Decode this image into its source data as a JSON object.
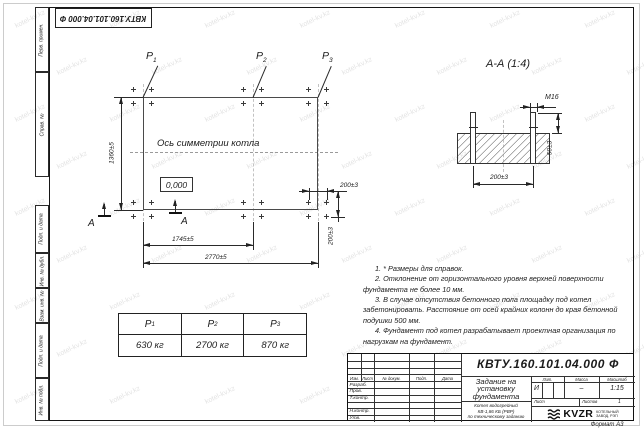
{
  "doc": {
    "number": "КВТУ.160.101.04.000 Ф",
    "format": "Формат А3",
    "watermark": "kotel-kv.kz"
  },
  "margin_fields": [
    "Перв. примен.",
    "Справ. №",
    "Подп. и дата",
    "Инв. № дубл.",
    "Взам. инв. №",
    "Подп. и дата",
    "Инв. № подл."
  ],
  "plan": {
    "axis_label": "Ось симметрии котла",
    "elevation": "0,000",
    "dims": {
      "height": "1360±5",
      "width_inner": "1745±5",
      "width_total": "2770±5",
      "cluster_h": "200±3",
      "cluster_v": "200±3"
    },
    "section_letter": "А",
    "load_points": [
      {
        "base": "P",
        "sub": "1"
      },
      {
        "base": "P",
        "sub": "2"
      },
      {
        "base": "P",
        "sub": "3"
      }
    ]
  },
  "section": {
    "title": "А-А (1:4)",
    "thread": "М16",
    "dims": {
      "spacing": "200±3",
      "protrusion": "50±3"
    }
  },
  "load_table": {
    "headers": [
      {
        "base": "P",
        "sub": "1"
      },
      {
        "base": "P",
        "sub": "2"
      },
      {
        "base": "P",
        "sub": "3"
      }
    ],
    "values": [
      "630 кг",
      "2700 кг",
      "870 кг"
    ]
  },
  "notes": [
    "1. * Размеры для справок.",
    "2. Отклонение от горизонтального уровня верхней поверхности фундамента не более 10 мм.",
    "3. В случае отсутствия бетонного пола площадку под котел забетонировать. Расстояние от осей крайних колонн до края бетонной подушки 500 мм.",
    "4. Фундамент под котел разрабатывает проектная организация по нагрузкам на фундамент."
  ],
  "title_block": {
    "doc_number": "КВТУ.160.101.04.000 Ф",
    "title_lines": [
      "Задание на",
      "установку",
      "фундамента"
    ],
    "subtitle_lines": [
      "Котел водогрейный",
      "КВ-1,86 КБ (РВР)",
      "по техническому заданию"
    ],
    "change_cols": [
      "Изм.",
      "Лист",
      "№ докум.",
      "Подп.",
      "Дата"
    ],
    "sign_rows": [
      "Разраб.",
      "Пров.",
      "Т.контр.",
      "Н.контр.",
      "Утв."
    ],
    "lit_label": "Лит.",
    "lit_value": "И",
    "mass_label": "Масса",
    "mass_value": "–",
    "scale_label": "Масштаб",
    "scale_value": "1:15",
    "sheet_label": "Лист",
    "sheets_label": "Листов",
    "sheets_value": "1",
    "logo_text": "KVZR",
    "logo_caption": [
      "КОТЕЛЬНЫЙ",
      "ЗАВОД, РЭП"
    ]
  }
}
